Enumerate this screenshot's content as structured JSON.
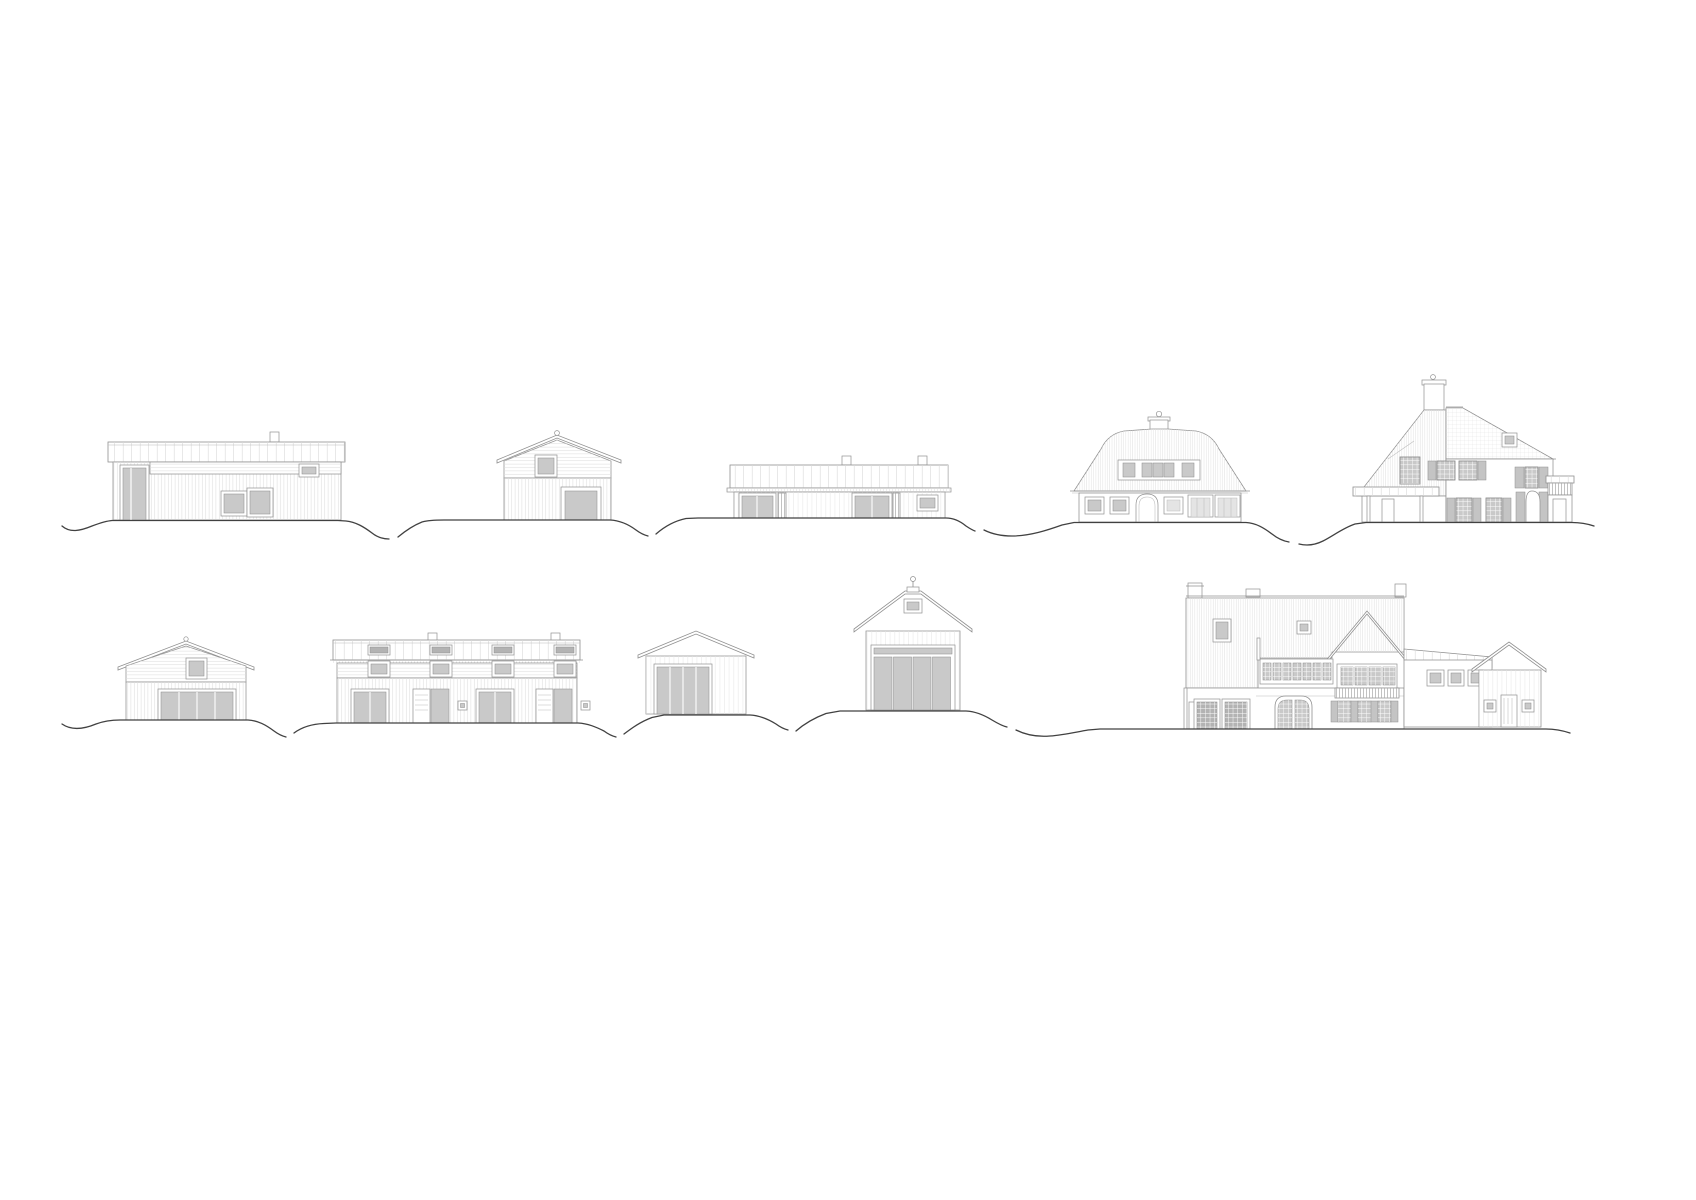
{
  "canvas": {
    "width": 1696,
    "height": 1200,
    "background": "#ffffff"
  },
  "palette": {
    "line": "#909090",
    "line_soft": "#bcbcbc",
    "terrain": "#414141",
    "glass": "#c9c9c9",
    "glass_dark": "#b3b3b3",
    "glass_pale": "#e4e4e4",
    "shutter": "#c4c4c4",
    "background": "#ffffff"
  },
  "drawing": {
    "type": "architectural-elevation-sheet",
    "rows": [
      {
        "buildings": [
          "flat-roof-outbuilding",
          "small-gable-cabin",
          "long-low-pavilion",
          "mansard-roof-house",
          "steep-roof-villa"
        ]
      },
      {
        "buildings": [
          "small-gable-barn",
          "terraced-row-house",
          "garage",
          "hip-roof-pavilion",
          "large-country-house"
        ]
      }
    ]
  }
}
